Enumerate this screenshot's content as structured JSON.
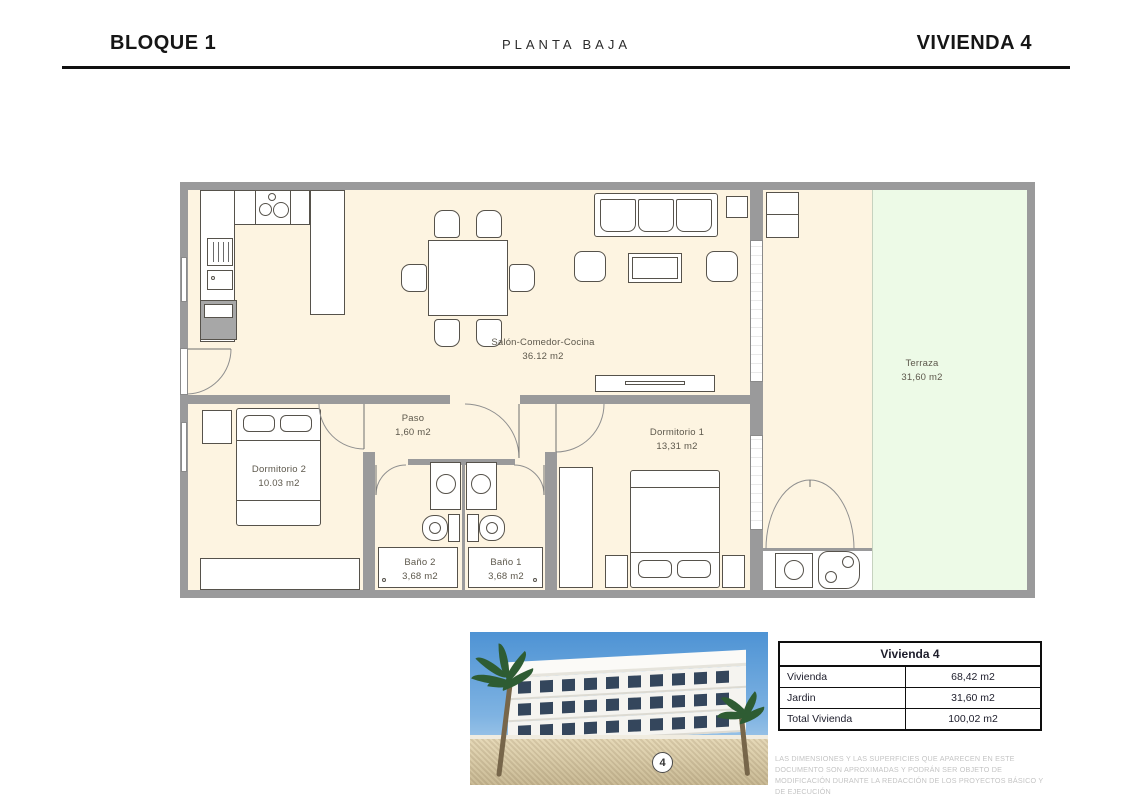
{
  "header": {
    "left": "BLOQUE 1",
    "center": "PLANTA BAJA",
    "right": "VIVIENDA 4"
  },
  "plan": {
    "rooms": {
      "salon": {
        "name": "Salón-Comedor-Cocina",
        "area": "36.12 m2"
      },
      "paso": {
        "name": "Paso",
        "area": "1,60 m2"
      },
      "dorm1": {
        "name": "Dormitorio 1",
        "area": "13,31 m2"
      },
      "dorm2": {
        "name": "Dormitorio 2",
        "area": "10.03 m2"
      },
      "bano1": {
        "name": "Baño 1",
        "area": "3,68 m2"
      },
      "bano2": {
        "name": "Baño 2",
        "area": "3,68 m2"
      },
      "terraza": {
        "name": "Terraza",
        "area": "31,60 m2"
      }
    },
    "colors": {
      "wall": "#9a9a9b",
      "floor": "#fdf4e1",
      "garden": "#edfae7"
    }
  },
  "photo": {
    "badge": "4"
  },
  "summary_table": {
    "title": "Vivienda 4",
    "rows": [
      {
        "label": "Vivienda",
        "value": "68,42 m2"
      },
      {
        "label": "Jardin",
        "value": "31,60 m2"
      },
      {
        "label": "Total Vivienda",
        "value": "100,02 m2"
      }
    ]
  },
  "disclaimer": "LAS DIMENSIONES Y LAS SUPERFICIES QUE APARECEN EN ESTE DOCUMENTO SON APROXIMADAS Y PODRÁN SER OBJETO DE MODIFICACIÓN DURANTE LA REDACCIÓN DE LOS PROYECTOS BÁSICO Y DE EJECUCIÓN"
}
